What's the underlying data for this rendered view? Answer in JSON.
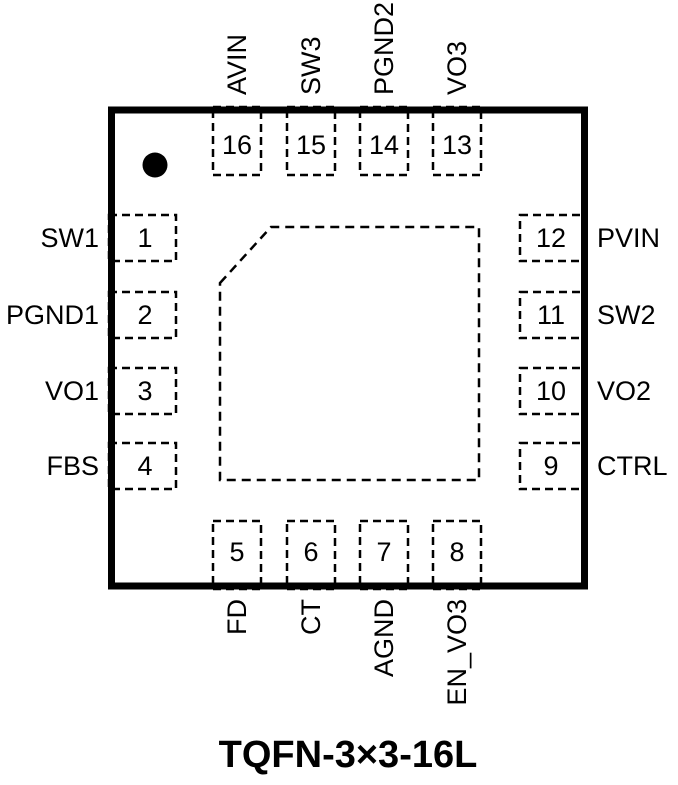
{
  "colors": {
    "line": "#000000",
    "background": "#ffffff"
  },
  "title": "TQFN-3×3-16L",
  "markers": {
    "pin1_indicator": "filled-circle"
  },
  "pins": {
    "top": [
      {
        "num": "16",
        "label": "AVIN"
      },
      {
        "num": "15",
        "label": "SW3"
      },
      {
        "num": "14",
        "label": "PGND2"
      },
      {
        "num": "13",
        "label": "VO3"
      }
    ],
    "left": [
      {
        "num": "1",
        "label": "SW1"
      },
      {
        "num": "2",
        "label": "PGND1"
      },
      {
        "num": "3",
        "label": "VO1"
      },
      {
        "num": "4",
        "label": "FBS"
      }
    ],
    "right": [
      {
        "num": "12",
        "label": "PVIN"
      },
      {
        "num": "11",
        "label": "SW2"
      },
      {
        "num": "10",
        "label": "VO2"
      },
      {
        "num": "9",
        "label": "CTRL"
      }
    ],
    "bottom": [
      {
        "num": "5",
        "label": "FD"
      },
      {
        "num": "6",
        "label": "CT"
      },
      {
        "num": "7",
        "label": "AGND"
      },
      {
        "num": "8",
        "label": "EN_VO3"
      }
    ]
  }
}
